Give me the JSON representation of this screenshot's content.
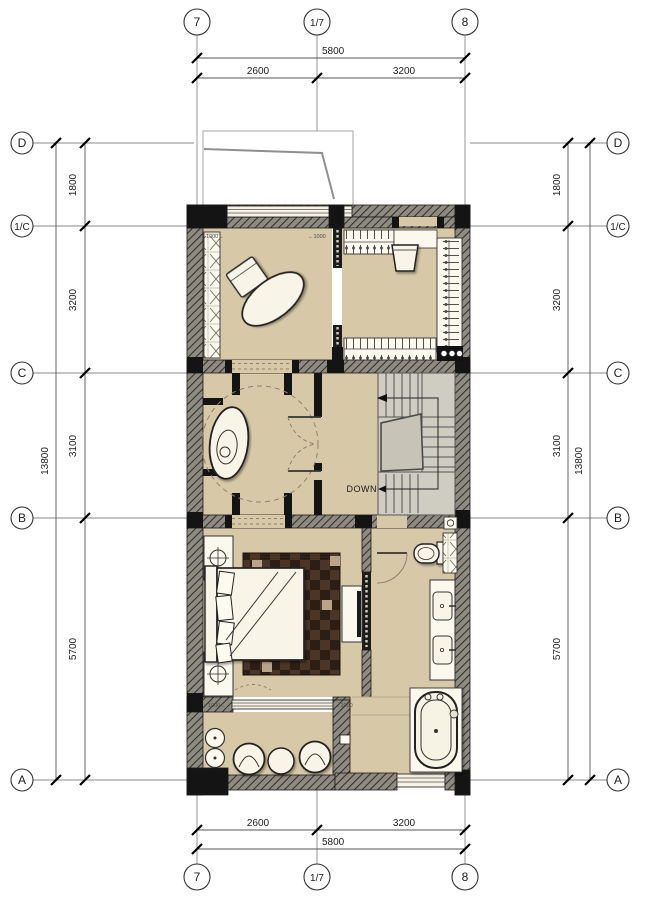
{
  "plan": {
    "grid_bubbles": {
      "top": [
        "7",
        "1/7",
        "8"
      ],
      "bottom": [
        "7",
        "1/7",
        "8"
      ],
      "left": [
        "D",
        "1/C",
        "C",
        "B",
        "A"
      ],
      "right": [
        "D",
        "1/C",
        "C",
        "B",
        "A"
      ]
    },
    "dimensions": {
      "top": {
        "total": "5800",
        "segments": [
          "2600",
          "3200"
        ]
      },
      "bottom": {
        "total": "5800",
        "segments": [
          "2600",
          "3200"
        ]
      },
      "left": {
        "total": "13800",
        "segments": [
          "1800",
          "3200",
          "3100",
          "5700"
        ]
      },
      "right": {
        "total": "13800",
        "segments": [
          "1800",
          "3200",
          "3100",
          "5700"
        ]
      }
    },
    "labels": {
      "stairs_down": "DOWN",
      "door_top_left": "1000→",
      "door_top_right": "←1000",
      "door_bottom_left": "1000→",
      "door_bottom_right": "←1000"
    },
    "colors": {
      "floor": "#d7c9a8",
      "stair_floor": "#cfccc1",
      "landing": "#c7c4b7",
      "wall_hatch_base": "#8f8b80",
      "wall_dark": "#141414",
      "furniture": "#f8f4e7",
      "rug_dark": "#2c1e14",
      "rug_light": "#4a3526",
      "dash_accent": "#8f8068"
    }
  }
}
